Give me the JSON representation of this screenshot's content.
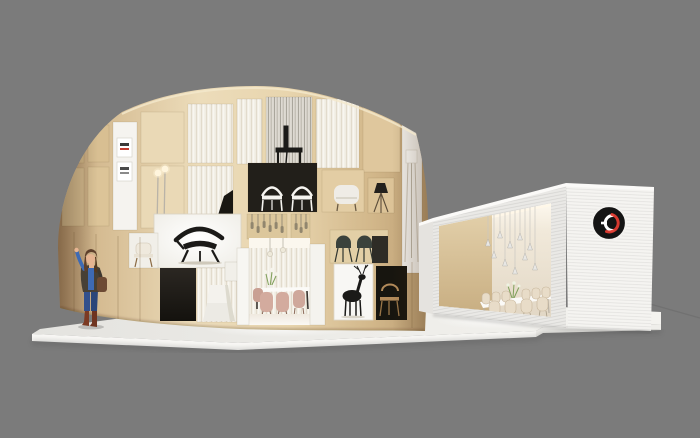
{
  "window": {
    "title": "Exhibition booth 3D render"
  },
  "canvas": {
    "width": 700,
    "height": 438
  },
  "colors": {
    "background": "#7b7b7b",
    "floor_shadow": "#646464",
    "platform_top": "#ecebe7",
    "platform_top_light": "#f4f3ef",
    "platform_front": "#f9f8f5",
    "platform_step": "#efeeea",
    "wood": "#e6d4ae",
    "wood_dark": "#bda077",
    "wood_light": "#f0e0bd",
    "cell_back": "#ead9b6",
    "curtain": "#f2eee5",
    "curtain_line": "#e0d9c9",
    "mirror": "#dedad2",
    "dark_cell": "#221f1a",
    "darker_cell": "#17150f",
    "white_panel": "#f5f3ef",
    "billboard": "#fafaf7",
    "chair_black": "#1b1a18",
    "chair_white": "#f6f4f0",
    "armchair": "#efece6",
    "stool_dark": "#3a423c",
    "pink_chair": "#d3ab9e",
    "wood_chair": "#b28a5a",
    "box_front": "#eae9e6",
    "box_side": "#f5f4f1",
    "box_top": "#fbfaf8",
    "box_wood_wall": "#d8c39b",
    "box_back_wall": "#efe7da",
    "beige_chair": "#e8dcc8",
    "table_white": "#fbfaf7",
    "logo_black": "#141414",
    "logo_red": "#e23b30",
    "logo_white": "#ffffff",
    "plant_green": "#7fa05a",
    "skin": "#e6b491",
    "hair": "#5e3f2b",
    "jacket": "#474036",
    "shirt_blue": "#3e6ab4",
    "jeans": "#32508c",
    "boots": "#7c3a23",
    "bag": "#6d4a33"
  },
  "scene": {
    "background_label": "studio gray backdrop",
    "platform_label": "white exhibition platform",
    "rotunda": {
      "label": "circular wooden shelf pavilion",
      "displays": [
        "poster panel with small prints",
        "sheer curtain cells",
        "black side chair on mirror back",
        "two white chairs on black back panel",
        "white armchair",
        "black tripod floor lamp",
        "twin globe floor lamp",
        "hero lightbox with black designer chair",
        "hanging glass bottle pendants",
        "two dark counter stools",
        "cream display chair",
        "black deer art print",
        "wooden hoop chair in dark niche",
        "white pedestal",
        "dark doorway",
        "dining nook with blush chairs, flowers and glass pendants"
      ]
    },
    "annex_box": {
      "label": "white slatted annex box",
      "interior": [
        "light wood feature wall",
        "cluster of cone pendant lights",
        "white dining table",
        "beige shell chairs",
        "green table plant"
      ],
      "logo_icon": "go-interlocked-logo",
      "logo_description": "black circle badge with white and red interlocking G marks"
    },
    "figure_label": "woman waving, blue top, dark jacket, jeans, brown boots"
  }
}
